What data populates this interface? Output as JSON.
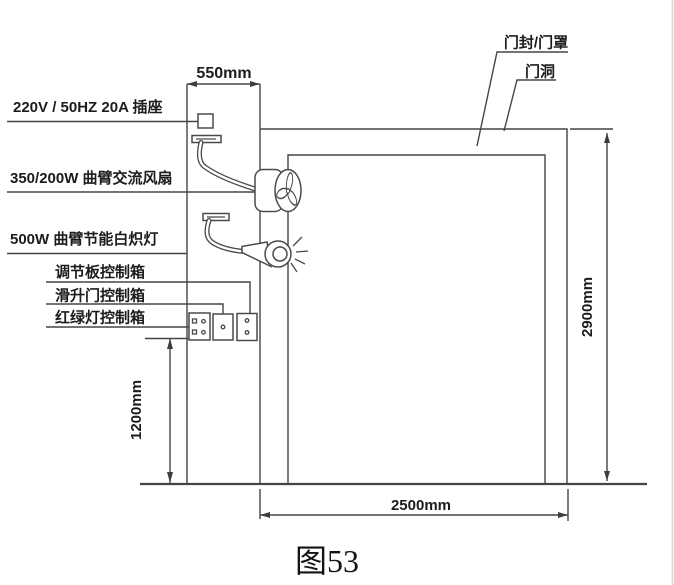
{
  "figure": {
    "caption": "图53",
    "equipment_labels": {
      "socket": "220V / 50HZ 20A 插座",
      "fan": "350/200W 曲臂交流风扇",
      "lamp": "500W 曲臂节能白炽灯",
      "regulator_box": "调节板控制箱",
      "sliding_door_box": "滑升门控制箱",
      "traffic_light_box": "红绿灯控制箱"
    },
    "structure_labels": {
      "door_seal": "门封/门罩",
      "door_opening": "门洞"
    },
    "dimensions": {
      "wall_offset": "550mm",
      "opening_height": "2900mm",
      "opening_width": "2500mm",
      "control_box_height": "1200mm"
    },
    "colors": {
      "line": "#454545",
      "text": "#1c1c1c",
      "background": "#ffffff"
    }
  }
}
